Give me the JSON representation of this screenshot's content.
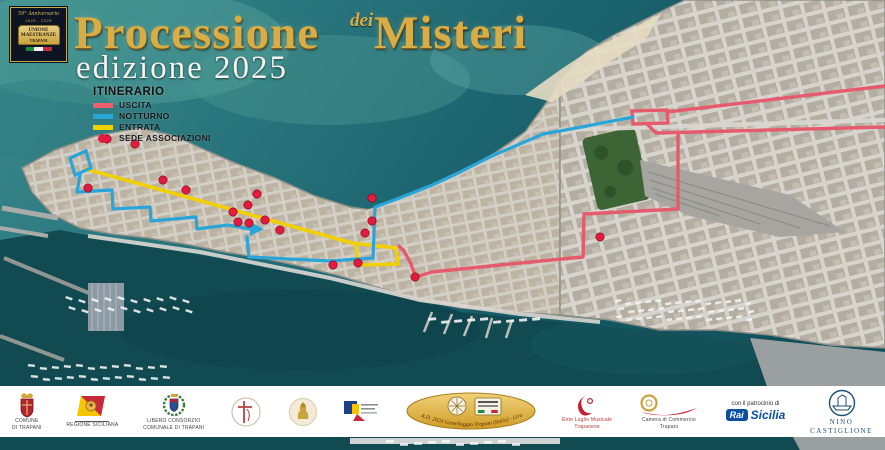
{
  "badge": {
    "line1": "59° Anniversario",
    "line2": "1925 - 2025",
    "plaque1": "UNIONE",
    "plaque2": "MAESTRANZE",
    "plaque3": "TRAPANI"
  },
  "title": {
    "word1": "Processione",
    "dei": "dei",
    "word2": "Misteri",
    "edition": "edizione 2025"
  },
  "legend": {
    "title": "ITINERARIO",
    "items": [
      {
        "label": "USCITA",
        "color": "#ee5f72",
        "shape": "line"
      },
      {
        "label": "NOTTURNO",
        "color": "#2aa5d8",
        "shape": "line"
      },
      {
        "label": "ENTRATA",
        "color": "#f2cf00",
        "shape": "line"
      },
      {
        "label": "SEDE ASSOCIAZIONI",
        "color": "#e31b3f",
        "shape": "dot"
      }
    ]
  },
  "map": {
    "routes": [
      {
        "name": "entrata",
        "color": "#f2cf00",
        "width": 3.6,
        "polylines": [
          "86,169 352,243 396,248 398,264 358,265 356,246"
        ]
      },
      {
        "name": "uscita",
        "color": "#e65a6d",
        "width": 3.4,
        "polylines": [
          "885,86 667,112",
          "648,125 656,133 885,127",
          "678,134 678,209 584,214 583,257 500,265 432,272 416,277",
          "416,277 410,262 404,251 399,246"
        ],
        "polygons": [
          "632,111 667,110 668,123 633,124"
        ]
      },
      {
        "name": "notturno",
        "color": "#2aa5d8",
        "width": 3.2,
        "polylines": [
          "80,175 77,192 112,190 113,209 150,207 151,221 196,217 197,229 228,225 250,229",
          "247,237 249,257 330,261 373,258 375,207 397,199 430,186 456,174 492,156 543,134 582,127 633,117"
        ],
        "polygons": [
          "70,158 86,151 91,168 75,175"
        ],
        "arrows": [
          "250,222 264,229 250,236"
        ]
      }
    ],
    "association_dots": {
      "color": "#e31b3f",
      "points": [
        [
          107,
          139
        ],
        [
          88,
          188
        ],
        [
          135,
          144
        ],
        [
          163,
          180
        ],
        [
          186,
          190
        ],
        [
          233,
          212
        ],
        [
          238,
          222
        ],
        [
          248,
          205
        ],
        [
          249,
          223
        ],
        [
          257,
          194
        ],
        [
          265,
          220
        ],
        [
          280,
          230
        ],
        [
          333,
          265
        ],
        [
          358,
          263
        ],
        [
          365,
          233
        ],
        [
          372,
          221
        ],
        [
          372,
          198
        ],
        [
          415,
          277
        ],
        [
          600,
          237
        ]
      ]
    }
  },
  "sponsors": {
    "patronage_label": "con il patrocinio di",
    "comune": {
      "line1": "COMUNE",
      "line2": "DI TRAPANI"
    },
    "regione": {
      "caption": "REGIONE SICILIANA"
    },
    "consorzio": {
      "line1": "LIBERO CONSORZIO",
      "line2": "COMUNALE DI TRAPANI"
    },
    "gemellaggio": {
      "caption": "A.D. 2024 Gemellaggio Trapani (Italia) - Lira (Uganda)"
    },
    "luglio": {
      "line1": "Ente Luglio Musicale",
      "line2": "Trapanese"
    },
    "camera": {
      "line1": "Camera di Commercio",
      "line2": "Trapani"
    },
    "rai": {
      "logo": "Rai",
      "name": "Sicilia"
    },
    "nino": {
      "line1": "NINO",
      "line2": "CASTIGLIONE"
    }
  }
}
